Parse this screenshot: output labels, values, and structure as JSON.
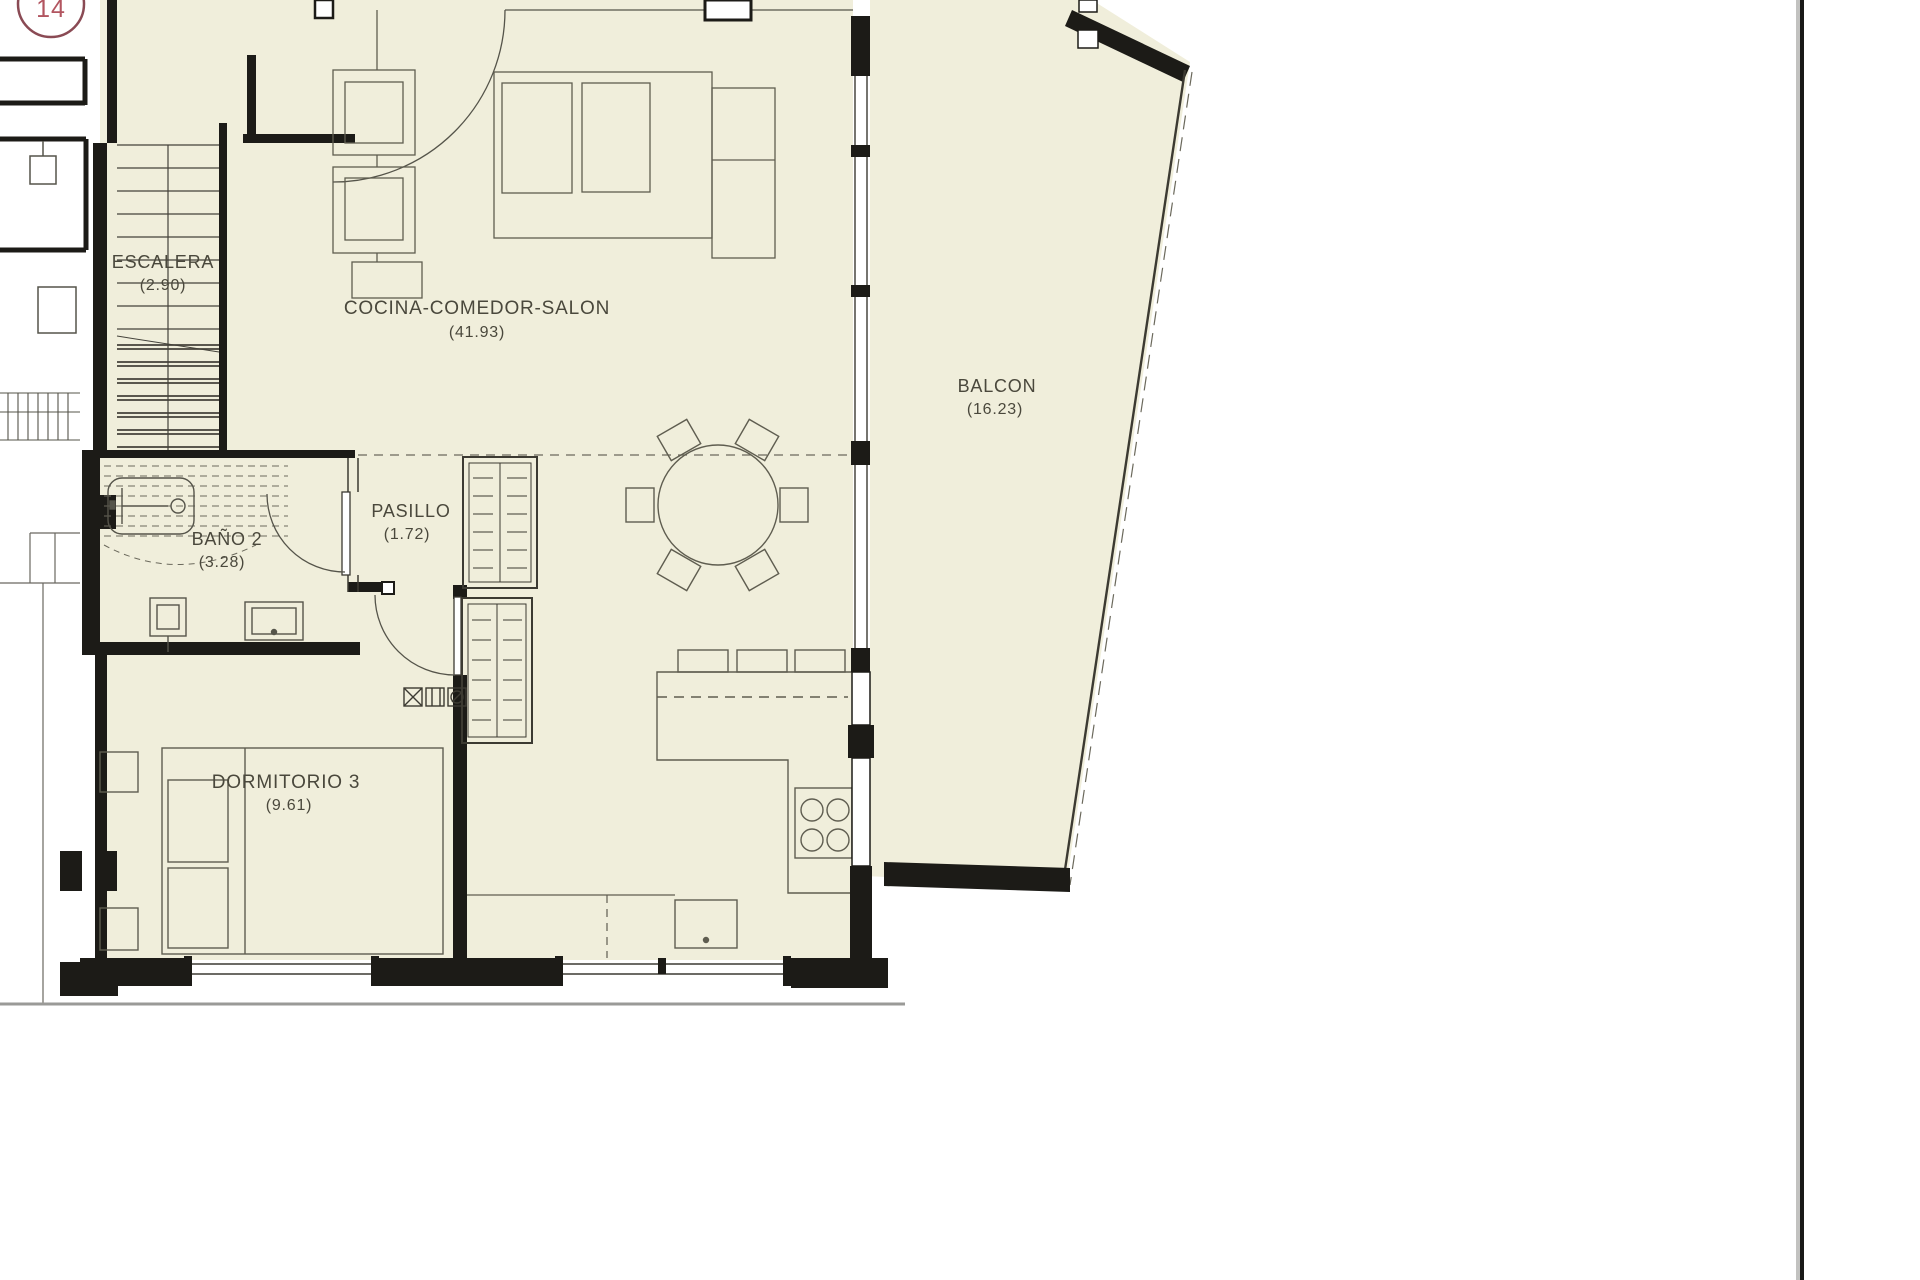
{
  "drawing": {
    "unit_number": "14",
    "rooms": {
      "escalera": {
        "name": "ESCALERA",
        "area": "(2.90)"
      },
      "cocina": {
        "name": "COCINA-COMEDOR-SALON",
        "area": "(41.93)"
      },
      "balcon": {
        "name": "BALCON",
        "area": "(16.23)"
      },
      "pasillo": {
        "name": "PASILLO",
        "area": "(1.72)"
      },
      "bano2": {
        "name": "BAÑO 2",
        "area": "(3.28)"
      },
      "dormitorio3": {
        "name": "DORMITORIO 3",
        "area": "(9.61)"
      }
    },
    "colors": {
      "floor": "#f0eedb",
      "wall": "#1c1b17",
      "accent_red": "#b25560"
    }
  }
}
